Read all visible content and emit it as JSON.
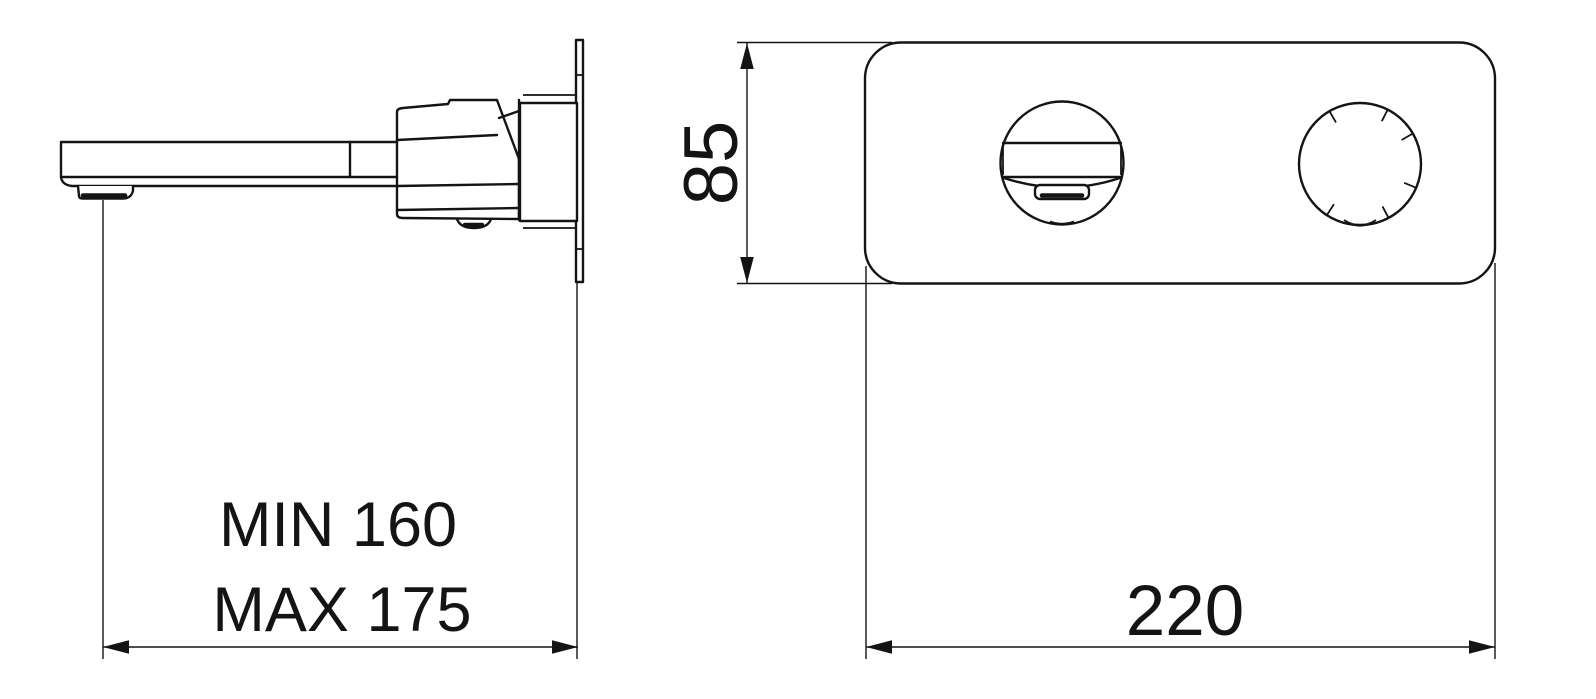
{
  "canvas": {
    "background": "#ffffff",
    "line_color": "#141414"
  },
  "labels": {
    "spout_reach_min": "MIN 160",
    "spout_reach_max": "MAX 175",
    "plate_height": "85",
    "plate_width": "220"
  }
}
